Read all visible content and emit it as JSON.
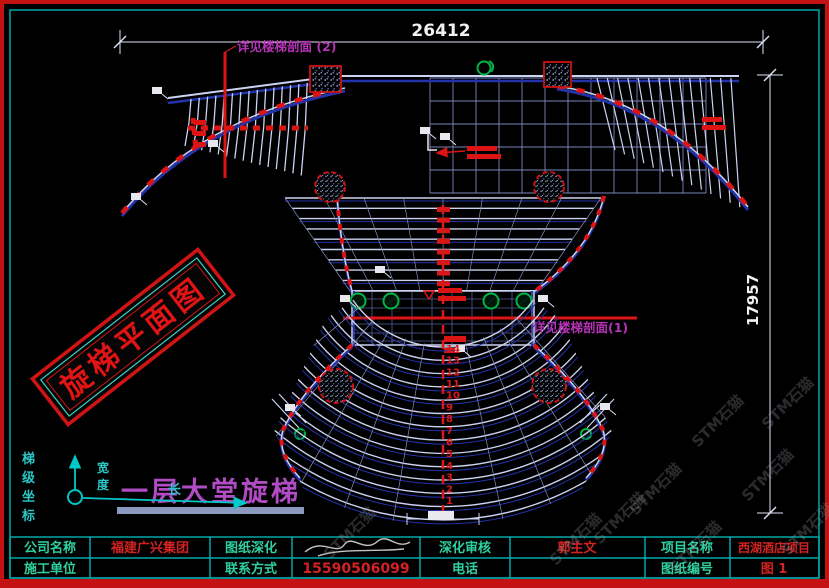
{
  "dimensions": {
    "top": "26412",
    "right": "17957"
  },
  "annotations": {
    "section_ref_2": "详见楼梯剖面 (2)",
    "section_ref_1": "详见楼梯剖面(1)"
  },
  "stamp": {
    "text": "旋梯平面图"
  },
  "caption": {
    "text": "一层大堂旋梯"
  },
  "axes": {
    "side_label": "梯级坐标",
    "v_label": "宽度",
    "h_label": "长"
  },
  "watermark": {
    "text": "STM石猫"
  },
  "drawing": {
    "step_numbers": [
      1,
      2,
      3,
      4,
      5,
      6,
      7,
      8,
      9,
      10,
      11,
      12,
      13,
      14
    ]
  },
  "title_block": {
    "company_label": "公司名称",
    "company_value": "福建广兴集团",
    "builder_label": "施工单位",
    "builder_value": "",
    "drafting_label": "图纸深化",
    "contact_label": "联系方式",
    "contact_value": "15590506099",
    "review_label": "深化审核",
    "review_value": "郭主文",
    "phone_label": "电话",
    "phone_value": "",
    "project_label": "项目名称",
    "project_value": "西湖酒店项目",
    "number_label": "图纸编号",
    "number_value": "图 1"
  },
  "colors": {
    "frame_red": "#c41212",
    "frame_cyan": "#00a8a8",
    "line_white": "#ccd3f0",
    "line_blue": "#2233aa",
    "grid": "#7d86ba",
    "red": "#dd1414",
    "green": "#00b544",
    "magenta": "#b733b7",
    "label_teal": "#2fd0a0",
    "value_red": "#d42222",
    "purple": "#b14cc4",
    "watermark_gray": "#9aa0a8"
  }
}
